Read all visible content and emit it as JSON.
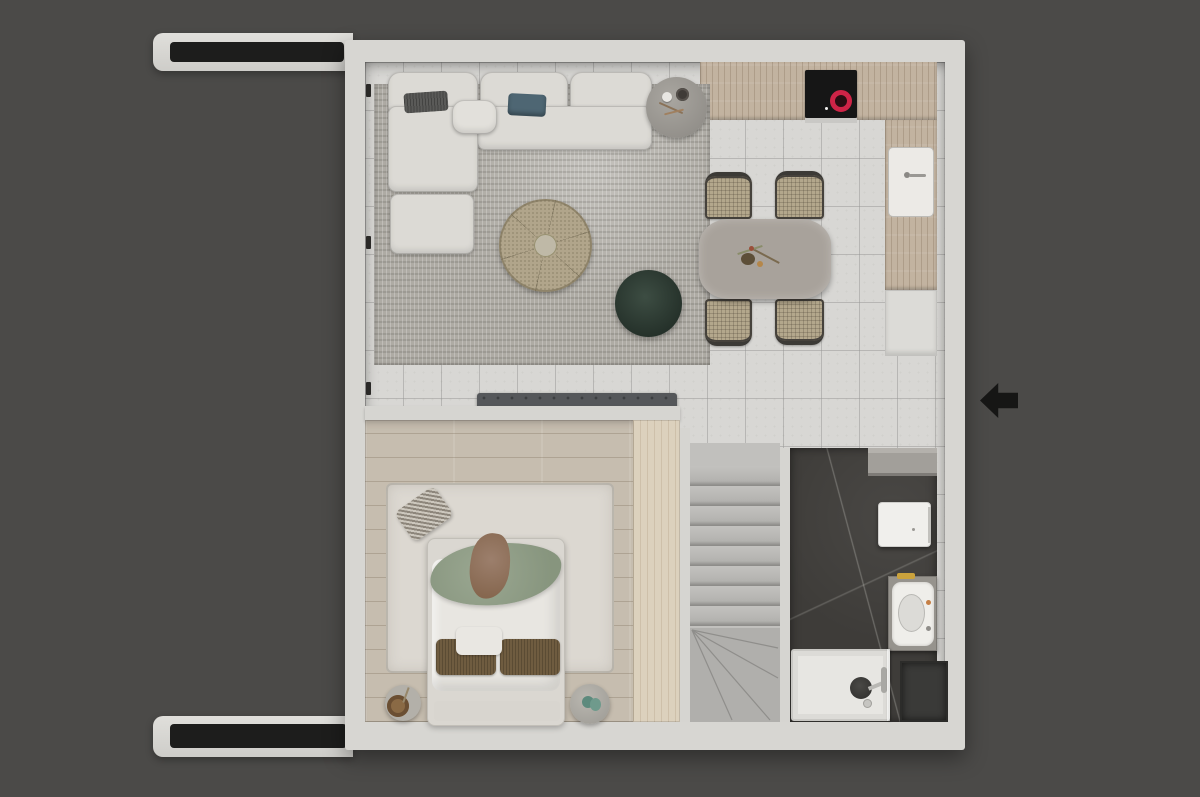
{
  "scene": {
    "type": "Top-down 3D rendered floor plan of a small apartment",
    "entry_arrow_direction": "left",
    "no_visible_text": true
  },
  "rooms": {
    "living_room": {
      "label": "living room",
      "items": [
        "l-shaped-sofa",
        "ottoman",
        "dark-throw-pillow",
        "teal-throw-pillow",
        "round-side-table",
        "round-rattan-coffee-table",
        "green-pouf",
        "mottled-area-rug"
      ]
    },
    "kitchen": {
      "label": "kitchen",
      "items": [
        "wood-upper-counter",
        "black-induction-cooktop-with-red-burner",
        "sink-with-faucet",
        "wood-side-counter",
        "white-base-cabinet"
      ]
    },
    "dining_area": {
      "label": "dining area",
      "items": [
        "rounded-dining-table",
        "rattan-dining-chair-1",
        "rattan-dining-chair-2",
        "rattan-dining-chair-3",
        "rattan-dining-chair-4",
        "table-centerpiece"
      ]
    },
    "hallway": {
      "label": "hallway",
      "items": [
        "tufted-bench"
      ]
    },
    "bedroom": {
      "label": "bedroom",
      "items": [
        "double-bed",
        "white-duvet",
        "green-throw-blanket",
        "brown-pillows",
        "white-pillows",
        "patterned-floor-cushion",
        "round-nightstand-left",
        "round-nightstand-right",
        "wardrobe",
        "white-rug",
        "wood-plank-floor"
      ]
    },
    "staircase": {
      "label": "staircase",
      "items": [
        "landing",
        "straight-flight",
        "winder-steps"
      ]
    },
    "bathroom": {
      "label": "bathroom",
      "items": [
        "dark-marble-floor",
        "storage-shelf",
        "white-wall-cabinet",
        "washbasin-vanity",
        "gold-soap-bar",
        "shower-tray",
        "shower-fixture",
        "floor-drain",
        "utility-recess"
      ]
    }
  },
  "palette": {
    "background": "#4b4a48",
    "wall": "#d7d6d2",
    "wall_slot": "#1d1d1c",
    "tile_floor": "#d8d7d4",
    "living_rug": "#aeaba4",
    "kitchen_wood": "#c2b3a0",
    "cooktop": "#161616",
    "burner_red": "#cf2447",
    "dining_table": "#a8a29b",
    "chair_rattan": "#b3a78c",
    "sofa": "#dcdad5",
    "coffee_table": "#b1a58b",
    "pouf_green": "#35453c",
    "bedroom_wood": "#c6bdaf",
    "bedroom_rug": "#dcd8d1",
    "throw_green": "#93a08a",
    "pillow_brown": "#6f5c40",
    "wardrobe_wood": "#dcd1bd",
    "stairs": "#b5b4b1",
    "bathroom_floor": "#3e3c39",
    "shower_tray": "#e7e6e2",
    "entry_arrow": "#161615"
  }
}
